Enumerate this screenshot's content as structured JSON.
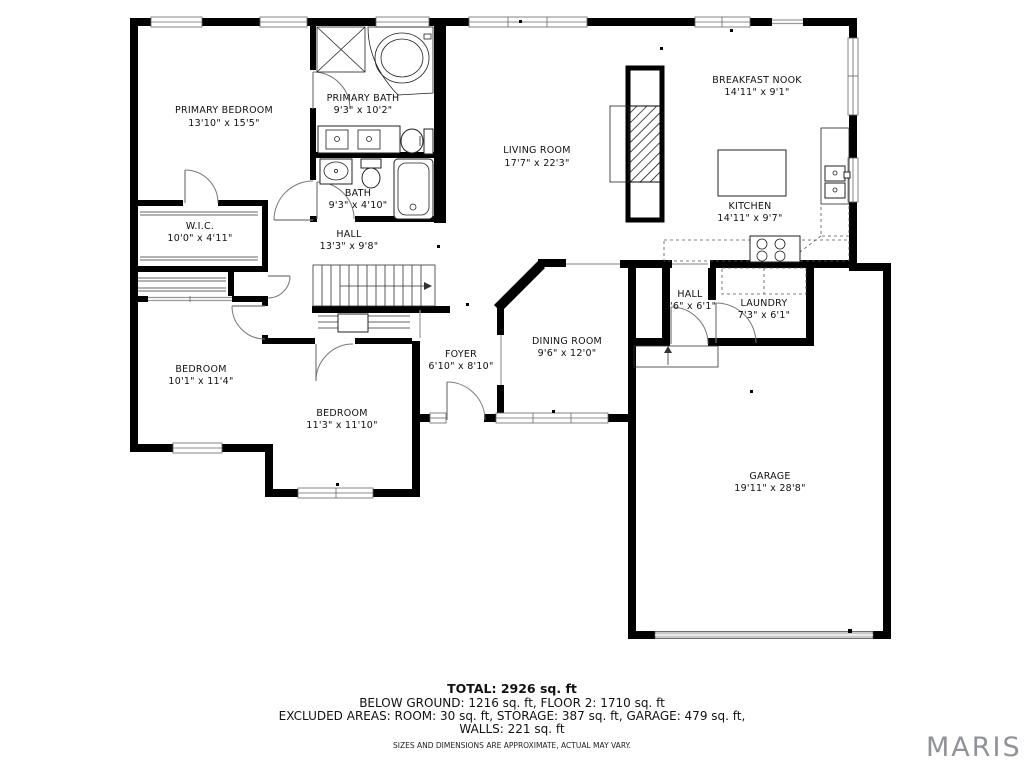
{
  "plan": {
    "rooms": [
      {
        "id": "primary-bedroom",
        "name": "PRIMARY BEDROOM",
        "dims": "13'10\" x 15'5\""
      },
      {
        "id": "primary-bath",
        "name": "PRIMARY BATH",
        "dims": "9'3\" x 10'2\""
      },
      {
        "id": "bath",
        "name": "BATH",
        "dims": "9'3\" x 4'10\""
      },
      {
        "id": "wic",
        "name": "W.I.C.",
        "dims": "10'0\" x 4'11\""
      },
      {
        "id": "hall",
        "name": "HALL",
        "dims": "13'3\" x 9'8\""
      },
      {
        "id": "living-room",
        "name": "LIVING ROOM",
        "dims": "17'7\" x 22'3\""
      },
      {
        "id": "breakfast-nook",
        "name": "BREAKFAST NOOK",
        "dims": "14'11\" x 9'1\""
      },
      {
        "id": "kitchen",
        "name": "KITCHEN",
        "dims": "14'11\" x 9'7\""
      },
      {
        "id": "hall-small",
        "name": "HALL",
        "dims": "3'6\" x 6'1\""
      },
      {
        "id": "laundry",
        "name": "LAUNDRY",
        "dims": "7'3\" x 6'1\""
      },
      {
        "id": "dining-room",
        "name": "DINING ROOM",
        "dims": "9'6\" x 12'0\""
      },
      {
        "id": "foyer",
        "name": "FOYER",
        "dims": "6'10\" x 8'10\""
      },
      {
        "id": "bedroom-1",
        "name": "BEDROOM",
        "dims": "10'1\" x 11'4\""
      },
      {
        "id": "bedroom-2",
        "name": "BEDROOM",
        "dims": "11'3\" x 11'10\""
      },
      {
        "id": "garage",
        "name": "GARAGE",
        "dims": "19'11\" x 28'8\""
      }
    ],
    "footer": {
      "total": "TOTAL: 2926 sq. ft",
      "line2": "BELOW GROUND: 1216 sq. ft, FLOOR 2: 1710 sq. ft",
      "line3": "EXCLUDED AREAS: ROOM: 30 sq. ft, STORAGE: 387 sq. ft, GARAGE: 479 sq. ft,",
      "line4": "WALLS: 221 sq. ft",
      "disclaimer": "SIZES AND DIMENSIONS ARE APPROXIMATE, ACTUAL MAY VARY."
    },
    "brand": "MARIS",
    "colors": {
      "wall": "#000000",
      "brand_gray": "#8f9298",
      "garage_door": "#c9c9c9"
    }
  }
}
